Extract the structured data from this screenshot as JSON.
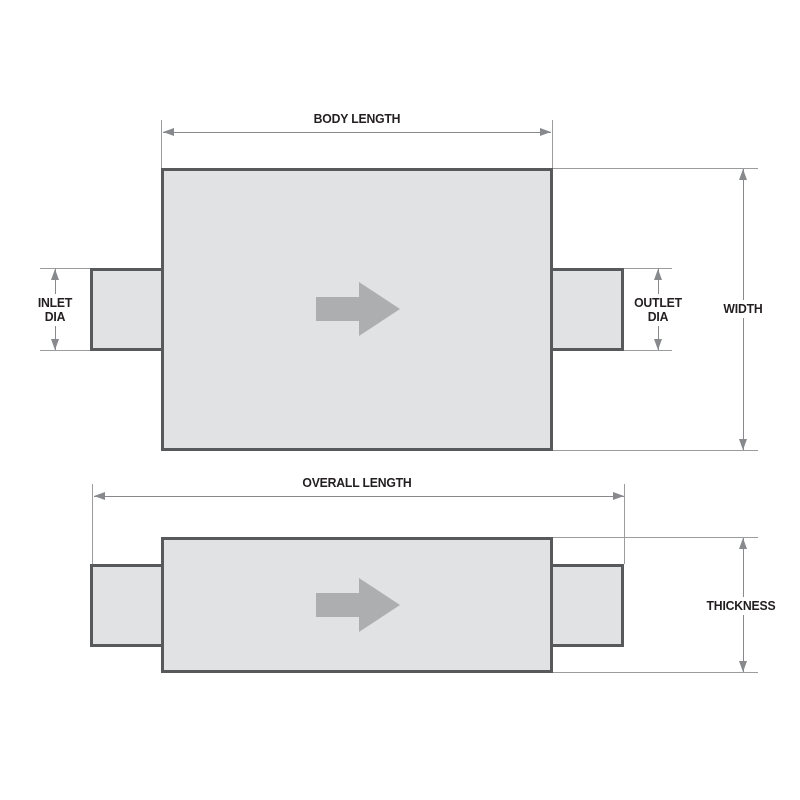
{
  "colors": {
    "background": "#ffffff",
    "part_fill": "#e1e2e4",
    "part_border": "#58595b",
    "dimension_line": "#87898c",
    "extension_line": "#9a9c9e",
    "label_text": "#231f20",
    "flow_arrow": "#acaeb0"
  },
  "icons": {
    "flow_direction": "arrow-right"
  },
  "top_view": {
    "labels": {
      "body_length": "BODY LENGTH",
      "inlet_dia_line1": "INLET",
      "inlet_dia_line2": "DIA",
      "outlet_dia_line1": "OUTLET",
      "outlet_dia_line2": "DIA",
      "width": "WIDTH"
    }
  },
  "bottom_view": {
    "labels": {
      "overall_length": "OVERALL LENGTH",
      "thickness": "THICKNESS"
    }
  }
}
